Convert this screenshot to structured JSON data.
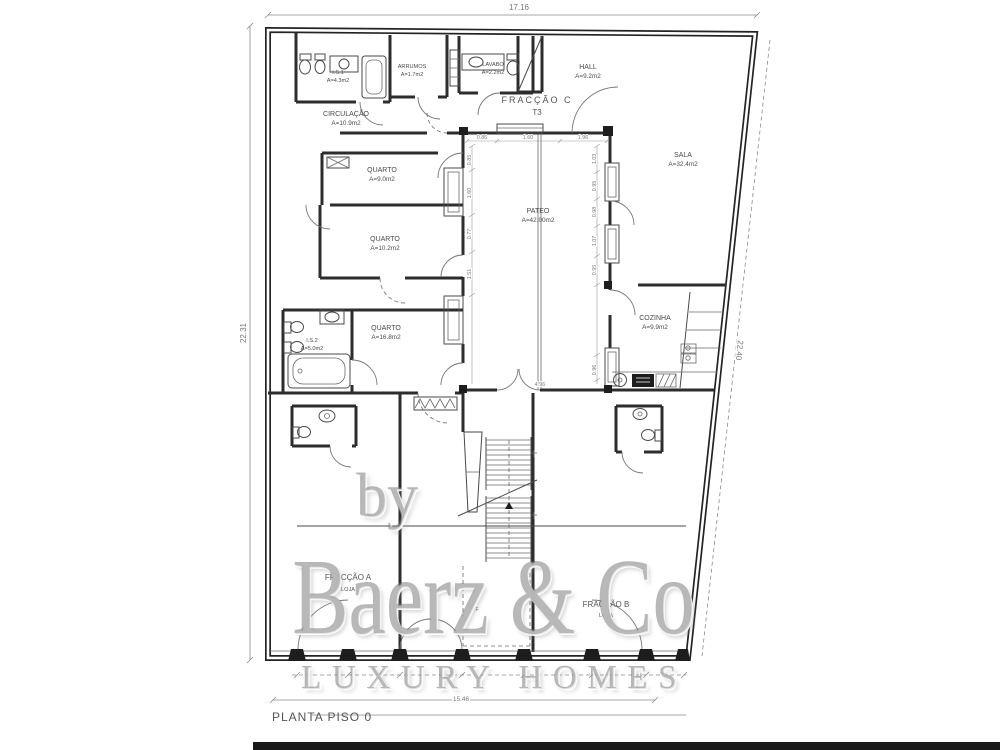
{
  "plan": {
    "title": "PLANTA PISO 0",
    "overall_dims": {
      "top": "17.16",
      "left": "22.31",
      "right": "22.40",
      "bottom": "15.46"
    },
    "fractions": {
      "c": {
        "name": "FRACÇÃO C",
        "type": "T3"
      },
      "a": {
        "name": "FRACÇÃO A",
        "type": "LOJA"
      },
      "b": {
        "name": "FRACÇÃO B",
        "type": "LOJA"
      }
    },
    "rooms": {
      "is1": {
        "name": "I.S.1",
        "area": "A=4.3m2"
      },
      "arrumos": {
        "name": "ARRUMOS",
        "area": "A=1.7m2"
      },
      "lavabo": {
        "name": "LAVABO",
        "area": "A=2.2m2"
      },
      "hall": {
        "name": "HALL",
        "area": "A=9.2m2"
      },
      "circulacao": {
        "name": "CIRCULAÇÃO",
        "area": "A=10.9m2"
      },
      "quarto1": {
        "name": "QUARTO",
        "area": "A=9.0m2"
      },
      "quarto2": {
        "name": "QUARTO",
        "area": "A=10.2m2"
      },
      "pateo": {
        "name": "PATEO",
        "area": "A=42.00m2"
      },
      "sala": {
        "name": "SALA",
        "area": "A=32.4m2"
      },
      "quarto3": {
        "name": "QUARTO",
        "area": "A=16.8m2"
      },
      "is2": {
        "name": "I.S.2",
        "area": "A=5.0m2"
      },
      "cozinha": {
        "name": "COZINHA",
        "area": "A=9.9m2"
      }
    },
    "stair_area_label": "ATF",
    "pateo_dims": {
      "top": [
        "0.86",
        "1.60",
        "1.96"
      ],
      "left": [
        "0.85",
        "1.60",
        "0.77",
        "1.51"
      ],
      "right": [
        "1.03",
        "0.95",
        "0.98",
        "1.07",
        "0.95",
        "0.96"
      ],
      "bottom": "4.96"
    }
  },
  "watermark": {
    "by": "by",
    "brand": "Baerz & Co",
    "tagline": "LUXURY HOMES"
  }
}
